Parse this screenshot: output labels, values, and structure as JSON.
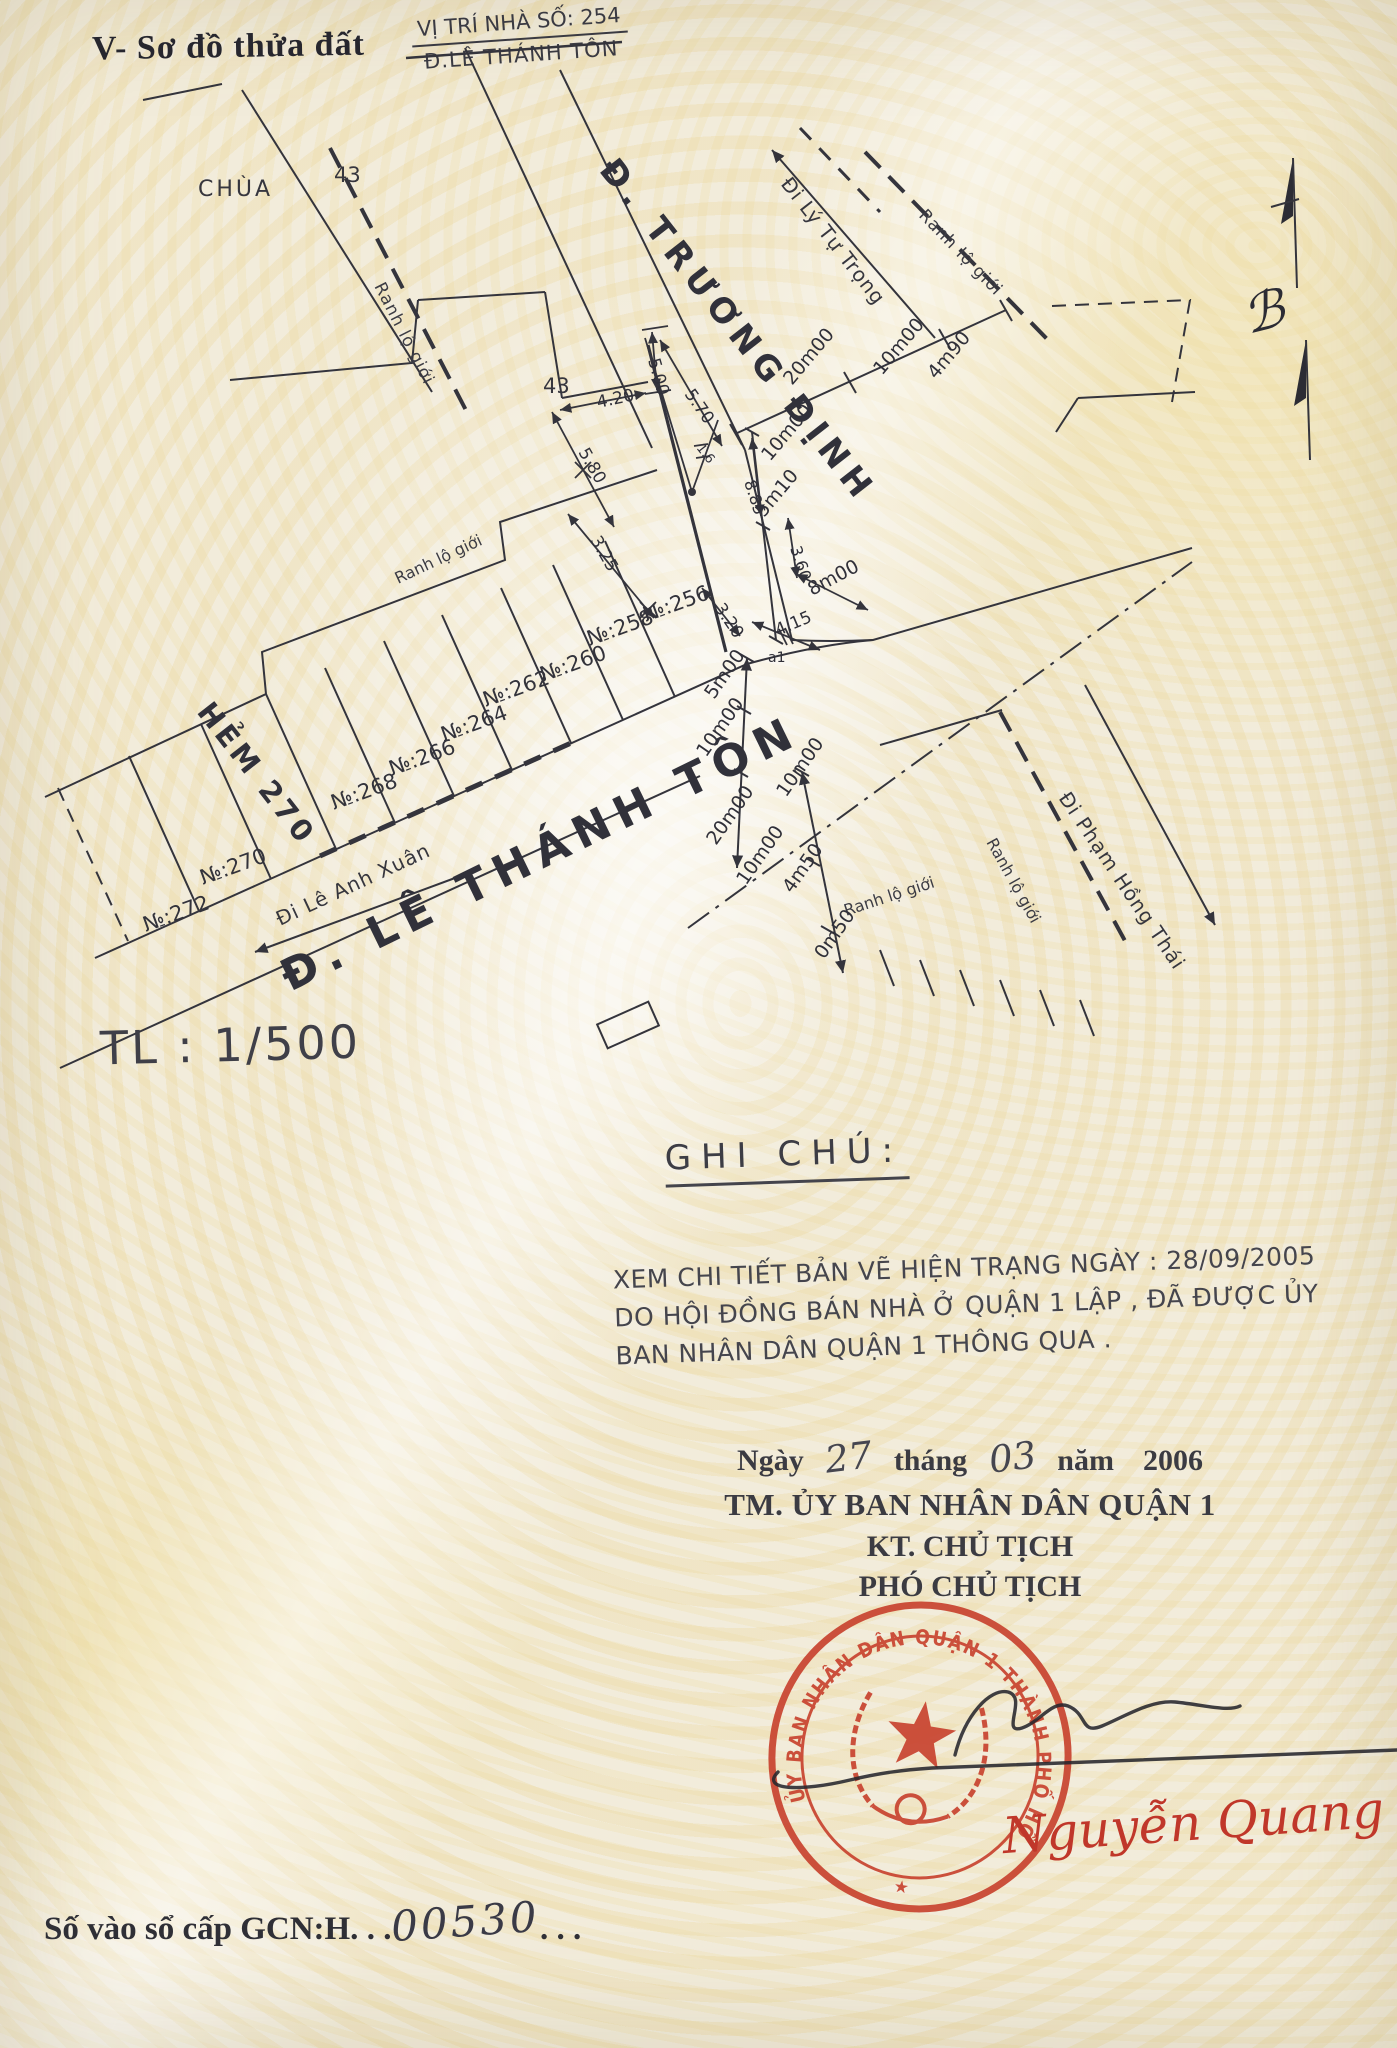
{
  "page": {
    "width": 1397,
    "height": 2048,
    "paper_color": "#f2ecdb",
    "ink_color": "#34343c",
    "stamp_color": "#c8432f"
  },
  "header": {
    "title": "V- Sơ đồ thửa đất",
    "location_line1": "VỊ TRÍ NHÀ SỐ: 254",
    "location_line2": "Đ.LÊ THÁNH TÔN"
  },
  "scale": {
    "label": "TL : 1/500"
  },
  "notes": {
    "heading": "GHI CHÚ:",
    "lines": [
      "XEM CHI TIẾT BẢN VẼ HIỆN TRẠNG NGÀY : 28/09/2005",
      "DO HỘI ĐỒNG BÁN NHÀ Ở QUẬN 1 LẬP , ĐÃ ĐƯỢC ỦY",
      "BAN NHÂN DÂN QUẬN 1 THÔNG QUA ."
    ]
  },
  "signing": {
    "date_prefix": "Ngày",
    "date_day": "27",
    "month_label": "tháng",
    "date_month": "03",
    "year_label": "năm",
    "date_year": "2006",
    "authority": "TM. ỦY BAN NHÂN DÂN QUẬN 1",
    "title_line1": "KT. CHỦ TỊCH",
    "title_line2": "PHÓ CHỦ TỊCH",
    "signer_name": "Nguyễn Quang C"
  },
  "stamp": {
    "ring_text": "ỦY BAN NHÂN DÂN QUẬN 1 THÀNH PHỐ HỒ CHÍ MINH",
    "star": "★"
  },
  "registry": {
    "prefix": "Số vào sổ cấp GCN:H.",
    "dots_before": " . .",
    "number": "00530",
    "dots_after": ". . ."
  },
  "map": {
    "labels": [
      {
        "text": "Đ. TRƯƠNG ĐỊNH",
        "x": 598,
        "y": 170,
        "rot": 52,
        "size": 34,
        "ls": 7,
        "cls": "street"
      },
      {
        "text": "Đ. LÊ THÁNH TÔN",
        "x": 290,
        "y": 992,
        "rot": -26,
        "size": 44,
        "ls": 9,
        "cls": "street"
      },
      {
        "text": "HẺM 270",
        "x": 196,
        "y": 712,
        "rot": 52,
        "size": 29,
        "ls": 4,
        "cls": "street"
      },
      {
        "text": "Đi Lý Tự Trọng",
        "x": 780,
        "y": 184,
        "rot": 52,
        "size": 20,
        "ls": 1,
        "cls": "way"
      },
      {
        "text": "Đi Lê Anh Xuân",
        "x": 280,
        "y": 926,
        "rot": -25,
        "size": 20,
        "ls": 1,
        "cls": "way"
      },
      {
        "text": "Đi Phạm Hồng Thái",
        "x": 1058,
        "y": 798,
        "rot": 56,
        "size": 20,
        "ls": 1,
        "cls": "way"
      },
      {
        "text": "CHÙA",
        "x": 198,
        "y": 196,
        "rot": 0,
        "size": 22,
        "ls": 3,
        "cls": "place"
      },
      {
        "text": "43",
        "x": 334,
        "y": 182,
        "rot": 0,
        "size": 21,
        "ls": 0,
        "cls": "place"
      },
      {
        "text": "43",
        "x": 543,
        "y": 393,
        "rot": 0,
        "size": 21,
        "ls": 0,
        "cls": "place"
      },
      {
        "text": "Ranh lộ giới",
        "x": 374,
        "y": 286,
        "rot": 63,
        "size": 17,
        "ls": 1,
        "cls": "note"
      },
      {
        "text": "Ranh lộ giới",
        "x": 918,
        "y": 216,
        "rot": 46,
        "size": 17,
        "ls": 1,
        "cls": "note"
      },
      {
        "text": "Ranh lộ giới",
        "x": 398,
        "y": 584,
        "rot": -25,
        "size": 16,
        "ls": 0,
        "cls": "note"
      },
      {
        "text": "Ranh lộ giới",
        "x": 846,
        "y": 916,
        "rot": -18,
        "size": 16,
        "ls": 0,
        "cls": "note"
      },
      {
        "text": "Ranh lộ giới",
        "x": 986,
        "y": 842,
        "rot": 61,
        "size": 16,
        "ls": 0,
        "cls": "note"
      },
      {
        "text": "№:256",
        "x": 646,
        "y": 622,
        "rot": -20,
        "size": 21,
        "ls": 0,
        "cls": "parcel"
      },
      {
        "text": "№:258",
        "x": 590,
        "y": 646,
        "rot": -20,
        "size": 21,
        "ls": 0,
        "cls": "parcel"
      },
      {
        "text": "№:260",
        "x": 543,
        "y": 682,
        "rot": -20,
        "size": 21,
        "ls": 0,
        "cls": "parcel"
      },
      {
        "text": "№:262",
        "x": 486,
        "y": 707,
        "rot": -20,
        "size": 21,
        "ls": 0,
        "cls": "parcel"
      },
      {
        "text": "№:264",
        "x": 444,
        "y": 742,
        "rot": -20,
        "size": 21,
        "ls": 0,
        "cls": "parcel"
      },
      {
        "text": "№:266",
        "x": 392,
        "y": 776,
        "rot": -20,
        "size": 21,
        "ls": 0,
        "cls": "parcel"
      },
      {
        "text": "№:268",
        "x": 334,
        "y": 810,
        "rot": -20,
        "size": 21,
        "ls": 0,
        "cls": "parcel"
      },
      {
        "text": "№:270",
        "x": 203,
        "y": 885,
        "rot": -20,
        "size": 21,
        "ls": 0,
        "cls": "parcel"
      },
      {
        "text": "№:272",
        "x": 146,
        "y": 932,
        "rot": -20,
        "size": 21,
        "ls": 0,
        "cls": "parcel"
      },
      {
        "text": "20m00",
        "x": 792,
        "y": 386,
        "rot": -50,
        "size": 19,
        "ls": 0,
        "cls": "dim"
      },
      {
        "text": "10m00",
        "x": 882,
        "y": 376,
        "rot": -50,
        "size": 19,
        "ls": 0,
        "cls": "dim"
      },
      {
        "text": "4m90",
        "x": 936,
        "y": 380,
        "rot": -50,
        "size": 19,
        "ls": 0,
        "cls": "dim"
      },
      {
        "text": "10m00",
        "x": 770,
        "y": 462,
        "rot": -50,
        "size": 19,
        "ls": 0,
        "cls": "dim"
      },
      {
        "text": "8.85",
        "x": 744,
        "y": 482,
        "rot": 72,
        "size": 16,
        "ls": 0,
        "cls": "dim"
      },
      {
        "text": "5m10",
        "x": 764,
        "y": 518,
        "rot": -50,
        "size": 19,
        "ls": 0,
        "cls": "dim"
      },
      {
        "text": "5.00",
        "x": 648,
        "y": 360,
        "rot": 74,
        "size": 17,
        "ls": 0,
        "cls": "dim"
      },
      {
        "text": "5.70",
        "x": 684,
        "y": 394,
        "rot": 55,
        "size": 17,
        "ls": 0,
        "cls": "dim"
      },
      {
        "text": "4.20",
        "x": 598,
        "y": 408,
        "rot": -12,
        "size": 17,
        "ls": 0,
        "cls": "dim"
      },
      {
        "text": "5.80",
        "x": 578,
        "y": 452,
        "rot": 60,
        "size": 17,
        "ls": 0,
        "cls": "dim"
      },
      {
        "text": "3.25",
        "x": 590,
        "y": 540,
        "rot": 60,
        "size": 17,
        "ls": 0,
        "cls": "dim"
      },
      {
        "text": "3.20",
        "x": 714,
        "y": 608,
        "rot": 56,
        "size": 17,
        "ls": 0,
        "cls": "dim"
      },
      {
        "text": "1.6",
        "x": 696,
        "y": 448,
        "rot": 52,
        "size": 13,
        "ls": 0,
        "cls": "dim"
      },
      {
        "text": "3.60",
        "x": 790,
        "y": 548,
        "rot": 72,
        "size": 16,
        "ls": 0,
        "cls": "dim"
      },
      {
        "text": "8m00",
        "x": 812,
        "y": 596,
        "rot": -28,
        "size": 19,
        "ls": 0,
        "cls": "dim"
      },
      {
        "text": "4.15",
        "x": 778,
        "y": 636,
        "rot": -23,
        "size": 17,
        "ls": 0,
        "cls": "dim"
      },
      {
        "text": "a1",
        "x": 768,
        "y": 662,
        "rot": 0,
        "size": 14,
        "ls": 0,
        "cls": "dim"
      },
      {
        "text": "5m00",
        "x": 714,
        "y": 700,
        "rot": -55,
        "size": 19,
        "ls": 0,
        "cls": "dim"
      },
      {
        "text": "10m00",
        "x": 706,
        "y": 758,
        "rot": -55,
        "size": 19,
        "ls": 0,
        "cls": "dim"
      },
      {
        "text": "10m00",
        "x": 786,
        "y": 798,
        "rot": -55,
        "size": 19,
        "ls": 0,
        "cls": "dim"
      },
      {
        "text": "20m00",
        "x": 716,
        "y": 846,
        "rot": -55,
        "size": 19,
        "ls": 0,
        "cls": "dim"
      },
      {
        "text": "10m00",
        "x": 746,
        "y": 886,
        "rot": -55,
        "size": 19,
        "ls": 0,
        "cls": "dim"
      },
      {
        "text": "4m50",
        "x": 792,
        "y": 894,
        "rot": -55,
        "size": 19,
        "ls": 0,
        "cls": "dim"
      },
      {
        "text": "0m50",
        "x": 824,
        "y": 960,
        "rot": -55,
        "size": 19,
        "ls": 0,
        "cls": "dim"
      },
      {
        "text": "ℬ",
        "x": 1248,
        "y": 334,
        "rot": -14,
        "size": 52,
        "ls": 0,
        "cls": "compass"
      }
    ]
  }
}
